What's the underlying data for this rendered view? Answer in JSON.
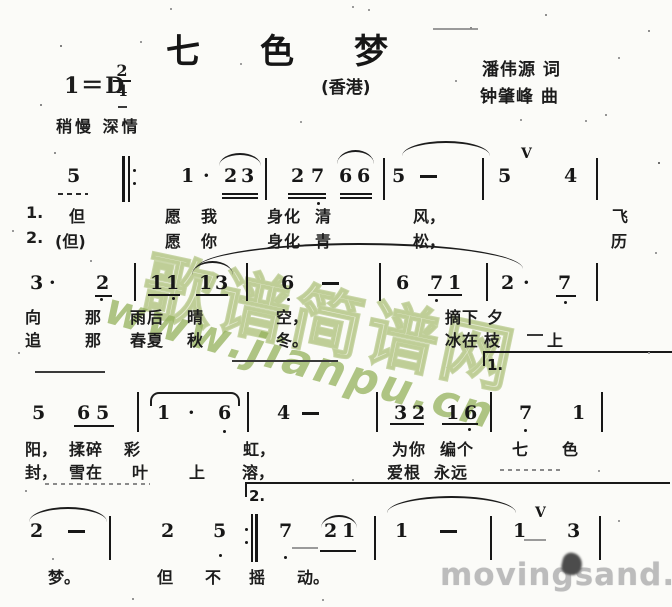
{
  "header": {
    "title": "七色梦",
    "key": "1＝D",
    "time_numerator": "2",
    "time_denominator": "4",
    "tempo": "稍慢 深情",
    "region": "(香港)",
    "lyricist": "潘伟源 词",
    "composer": "钟肇峰 曲"
  },
  "watermarks": {
    "site_name": "歌谱简谱网",
    "site_url": "www.jianpu.cn",
    "bottom_right": "movingsand.net",
    "green_hex": "#a8c07a",
    "gray_hex": "#bcbcbc"
  },
  "score": {
    "lines": [
      {
        "ny": 165,
        "by": 158,
        "bh": 42,
        "notes": [
          [
            "5",
            67
          ],
          [
            "1",
            181
          ],
          [
            "·",
            203
          ],
          [
            "2",
            224
          ],
          [
            "3",
            241
          ],
          [
            "2",
            291
          ],
          [
            "7",
            311
          ],
          [
            "6",
            339
          ],
          [
            "6",
            357
          ],
          [
            "5",
            392
          ],
          [
            "5",
            498
          ],
          [
            "4",
            564
          ]
        ],
        "dashes": [
          420
        ],
        "bars": [
          265,
          383,
          482,
          596
        ],
        "repeat_begin": 122,
        "beams": [
          [
            222,
            258,
            193,
            2
          ],
          [
            288,
            326,
            193,
            2
          ],
          [
            340,
            372,
            193,
            2
          ],
          [
            58,
            88,
            193,
            "d"
          ]
        ],
        "slurs": [
          [
            219,
            261,
            153,
            11
          ],
          [
            337,
            374,
            150,
            12
          ],
          [
            402,
            490,
            141,
            13
          ]
        ],
        "odots": [
          [
            317,
            202
          ]
        ],
        "breaths": [
          [
            521,
            146
          ]
        ],
        "lyrics": [
          {
            "y": 203,
            "items": [
              [
                "1.",
                26
              ],
              [
                "但",
                69
              ],
              [
                "愿",
                165
              ],
              [
                "我",
                201
              ],
              [
                "身",
                267
              ],
              [
                "化",
                284
              ],
              [
                "清",
                315
              ],
              [
                "风，",
                413
              ],
              [
                "飞",
                612
              ]
            ]
          },
          {
            "y": 228,
            "items": [
              [
                "2.",
                26
              ],
              [
                "(但)",
                55
              ],
              [
                "愿",
                165
              ],
              [
                "你",
                201
              ],
              [
                "身",
                267
              ],
              [
                "化",
                284
              ],
              [
                "青",
                315
              ],
              [
                "松，",
                413
              ],
              [
                "历",
                611
              ]
            ]
          }
        ]
      },
      {
        "ny": 272,
        "by": 263,
        "bh": 38,
        "notes": [
          [
            "3",
            30
          ],
          [
            "·",
            49
          ],
          [
            "2",
            96
          ],
          [
            "1",
            150
          ],
          [
            "1",
            166
          ],
          [
            "1",
            199
          ],
          [
            "3",
            215
          ],
          [
            "6",
            281
          ],
          [
            "6",
            396
          ],
          [
            "7",
            430
          ],
          [
            "1",
            448
          ],
          [
            "2",
            501
          ],
          [
            "·",
            523
          ],
          [
            "7",
            558
          ]
        ],
        "dashes": [
          322
        ],
        "bars": [
          134,
          246,
          379,
          486,
          596
        ],
        "beams": [
          [
            95,
            112,
            295
          ],
          [
            148,
            180,
            294
          ],
          [
            196,
            228,
            294
          ],
          [
            428,
            462,
            294
          ],
          [
            556,
            576,
            295
          ]
        ],
        "slurs": [
          [
            192,
            233,
            261,
            12
          ],
          [
            196,
            523,
            243,
            24
          ]
        ],
        "odots": [
          [
            100,
            298
          ],
          [
            172,
            297
          ],
          [
            287,
            298
          ],
          [
            435,
            299
          ],
          [
            564,
            301
          ]
        ],
        "breaths": [],
        "lyrics": [
          {
            "y": 304,
            "items": [
              [
                "向",
                25
              ],
              [
                "那",
                85
              ],
              [
                "雨",
                130
              ],
              [
                "后",
                147
              ],
              [
                "晴",
                187
              ],
              [
                "空，",
                276
              ],
              [
                "摘",
                445
              ],
              [
                "下",
                462
              ],
              [
                "夕",
                487
              ]
            ]
          },
          {
            "y": 327,
            "items": [
              [
                "追",
                25
              ],
              [
                "那",
                85
              ],
              [
                "春",
                130
              ],
              [
                "夏",
                147
              ],
              [
                "秋",
                187
              ],
              [
                "冬。",
                276
              ],
              [
                "冰",
                445
              ],
              [
                "在",
                462
              ],
              [
                "枝",
                484
              ],
              [
                "上",
                547
              ]
            ]
          }
        ]
      },
      {
        "ny": 402,
        "by": 392,
        "bh": 40,
        "notes": [
          [
            "5",
            32
          ],
          [
            "6",
            77
          ],
          [
            "5",
            96
          ],
          [
            "1",
            157
          ],
          [
            "·",
            188
          ],
          [
            "6",
            218
          ],
          [
            "4",
            277
          ],
          [
            "3",
            394
          ],
          [
            "2",
            412
          ],
          [
            "1",
            446
          ],
          [
            "6",
            464
          ],
          [
            "7",
            519
          ],
          [
            "1",
            572
          ]
        ],
        "dashes": [
          302
        ],
        "bars": [
          137,
          247,
          376,
          490,
          601
        ],
        "beams": [
          [
            74,
            114,
            425
          ],
          [
            390,
            424,
            423
          ],
          [
            442,
            478,
            423
          ]
        ],
        "slurs": [
          [
            150,
            236,
            392,
            12,
            "flat"
          ]
        ],
        "odots": [
          [
            223,
            430
          ],
          [
            468,
            428
          ],
          [
            524,
            429
          ]
        ],
        "breaths": [],
        "lyrics": [
          {
            "y": 436,
            "items": [
              [
                "阳，",
                25
              ],
              [
                "揉",
                69
              ],
              [
                "碎",
                86
              ],
              [
                "彩",
                124
              ],
              [
                "虹，",
                243
              ],
              [
                "为",
                392
              ],
              [
                "你",
                409
              ],
              [
                "编",
                440
              ],
              [
                "个",
                457
              ],
              [
                "七",
                512
              ],
              [
                "色",
                562
              ]
            ]
          },
          {
            "y": 459,
            "items": [
              [
                "封，",
                25
              ],
              [
                "雪",
                69
              ],
              [
                "在",
                86
              ],
              [
                "叶",
                132
              ],
              [
                "上",
                189
              ],
              [
                "溶，",
                242
              ],
              [
                "爱",
                387
              ],
              [
                "根",
                404
              ],
              [
                "永",
                434
              ],
              [
                "远",
                451
              ]
            ]
          }
        ]
      },
      {
        "ny": 520,
        "by": 516,
        "bh": 44,
        "notes": [
          [
            "2",
            30
          ],
          [
            "2",
            161
          ],
          [
            "5",
            213
          ],
          [
            "7",
            279
          ],
          [
            "2",
            324
          ],
          [
            "1",
            342
          ],
          [
            "1",
            395
          ],
          [
            "1",
            513
          ],
          [
            "3",
            567
          ]
        ],
        "dashes": [
          68,
          440
        ],
        "bars": [
          109,
          374,
          490,
          599
        ],
        "repeat_end": 245,
        "beams": [
          [
            320,
            356,
            550
          ]
        ],
        "slurs": [
          [
            29,
            107,
            507,
            13
          ],
          [
            321,
            357,
            515,
            11
          ],
          [
            387,
            516,
            496,
            15
          ]
        ],
        "odots": [
          [
            219,
            554
          ],
          [
            284,
            556
          ]
        ],
        "breaths": [
          [
            535,
            505
          ]
        ],
        "lyrics": [
          {
            "y": 564,
            "items": [
              [
                "梦。",
                48
              ],
              [
                "但",
                157
              ],
              [
                "不",
                205
              ],
              [
                "摇",
                249
              ],
              [
                "动。",
                297
              ]
            ]
          }
        ]
      }
    ],
    "voltas": [
      {
        "x1": 483,
        "x2": 670,
        "y": 351,
        "label": "1."
      },
      {
        "x1": 245,
        "x2": 668,
        "y": 482,
        "label": "2."
      }
    ],
    "stray_marks": [
      [
        35,
        371,
        70
      ],
      [
        232,
        360,
        106
      ],
      [
        527,
        334,
        16
      ],
      [
        45,
        483,
        105,
        "d"
      ],
      [
        292,
        547,
        26,
        "l"
      ],
      [
        524,
        539,
        22,
        "l"
      ],
      [
        500,
        469,
        60,
        "d"
      ],
      [
        433,
        28,
        45,
        "l"
      ],
      [
        118,
        106,
        9
      ]
    ]
  }
}
